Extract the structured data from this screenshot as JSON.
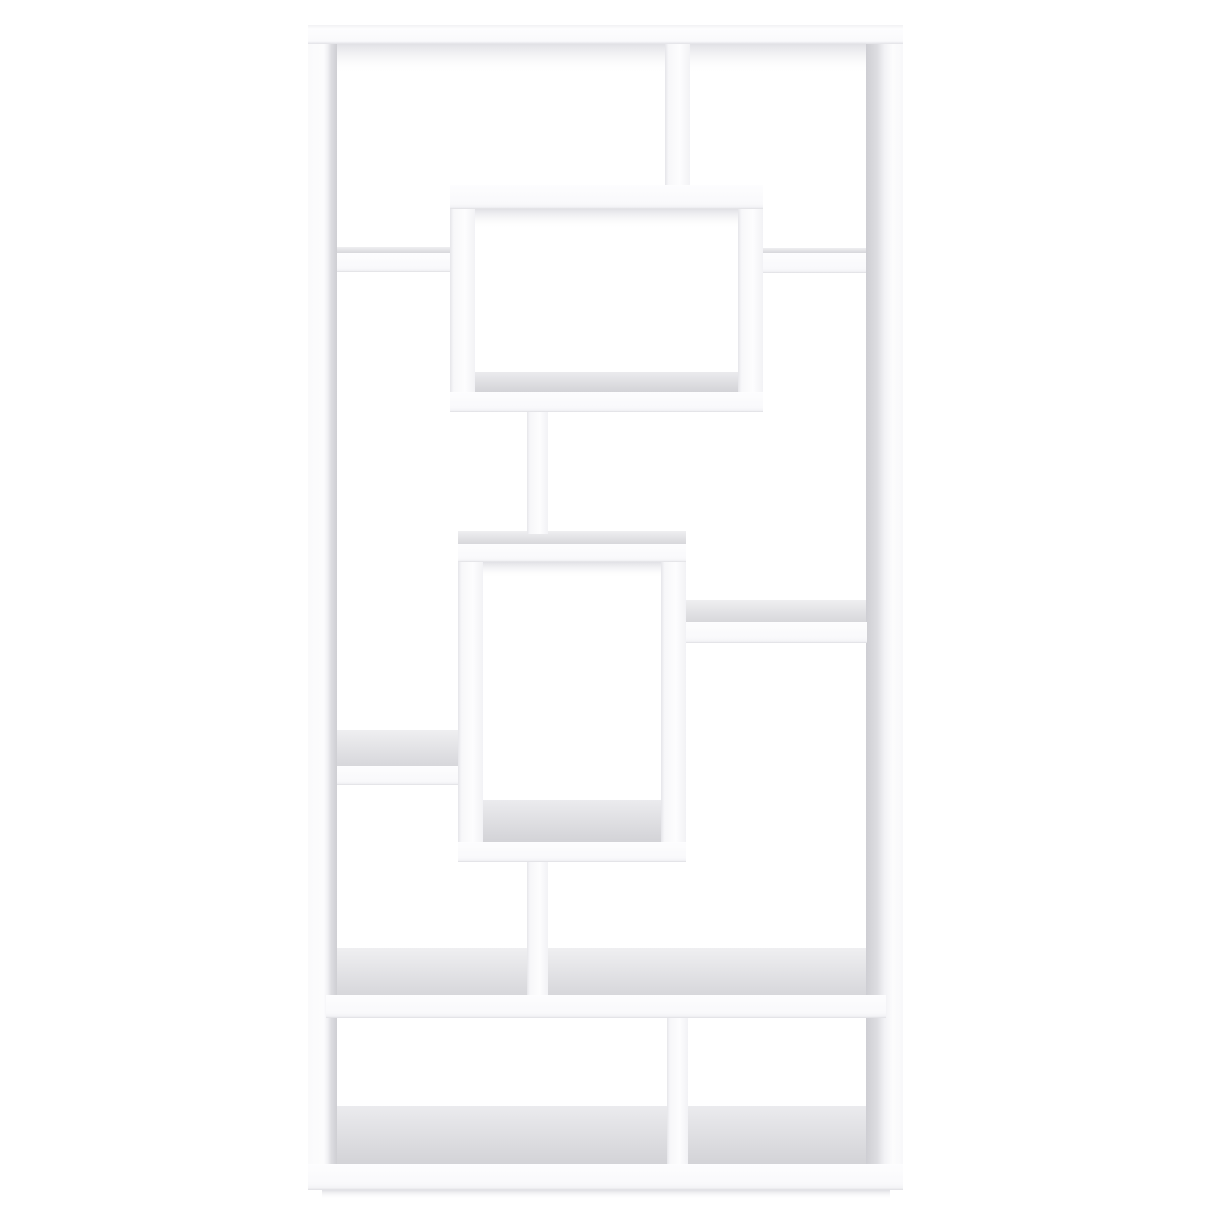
{
  "scene": {
    "width": 1214,
    "height": 1214,
    "background": "#ffffff",
    "alt": "Product photo of a tall white geometric bookcase with ten asymmetric open compartments, interlocking rectangular boxes and shelves, on a plain white background"
  },
  "palette": {
    "board_white": "#fcfcfd",
    "edge_gray": "#dedee2",
    "surface_gray": "#dcdcdf",
    "inner_face_gray": "#ceced3",
    "shadow_gray": "#c3c3cc"
  },
  "gradients": {
    "topBoardFace": {
      "dir": "v",
      "stops": [
        [
          0,
          "#f2f2f4"
        ],
        [
          0.2,
          "#fdfdfe"
        ],
        [
          0.85,
          "#fafafc"
        ],
        [
          1,
          "#e2e2e6"
        ]
      ]
    },
    "boardFace": {
      "dir": "v",
      "stops": [
        [
          0,
          "#fdfdfe"
        ],
        [
          0.78,
          "#f9f9fb"
        ],
        [
          0.92,
          "#f3f3f6"
        ],
        [
          1,
          "#dedee2"
        ]
      ]
    },
    "vertFace": {
      "dir": "h",
      "stops": [
        [
          0,
          "#e6e6ea"
        ],
        [
          0.14,
          "#f7f7f9"
        ],
        [
          0.6,
          "#fdfdfe"
        ],
        [
          1,
          "#f2f2f5"
        ]
      ]
    },
    "leftPost": {
      "dir": "h",
      "stops": [
        [
          0,
          "#fafafb"
        ],
        [
          0.55,
          "#fcfcfd"
        ],
        [
          0.68,
          "#f0f0f3"
        ],
        [
          0.8,
          "#dddde1"
        ],
        [
          1,
          "#ceced3"
        ]
      ]
    },
    "rightPost": {
      "dir": "h",
      "stops": [
        [
          0,
          "#ceced3"
        ],
        [
          0.3,
          "#dddde1"
        ],
        [
          0.5,
          "#f2f2f5"
        ],
        [
          0.72,
          "#fcfcfd"
        ],
        [
          1,
          "#f8f8fa"
        ]
      ]
    },
    "topSurf": {
      "dir": "v",
      "stops": [
        [
          0,
          "#efeff1"
        ],
        [
          1,
          "#d7d7db"
        ]
      ]
    },
    "floorSurf": {
      "dir": "v",
      "stops": [
        [
          0,
          "#ebebee"
        ],
        [
          1,
          "#d3d3d7"
        ]
      ]
    },
    "ceilShadow": {
      "dir": "v",
      "stops": [
        [
          0,
          "rgba(195,195,204,0.5)"
        ],
        [
          1,
          "rgba(255,255,255,0)"
        ]
      ]
    },
    "groundShadow": {
      "dir": "v",
      "stops": [
        [
          0,
          "rgba(185,185,195,0.45)"
        ],
        [
          1,
          "rgba(255,255,255,0)"
        ]
      ]
    }
  },
  "surfaces": [
    {
      "name": "top-opening-ceiling-shadow",
      "x": 337,
      "y": 44,
      "w": 529,
      "h": 30,
      "fill": "ceilShadow"
    },
    {
      "name": "upper-box-ceiling-shadow",
      "x": 475,
      "y": 209,
      "w": 263,
      "h": 20,
      "fill": "ceilShadow"
    },
    {
      "name": "upper-box-floor-surface",
      "x": 475,
      "y": 372,
      "w": 263,
      "h": 20,
      "fill": "floorSurf"
    },
    {
      "name": "left-shelf1-top-surface",
      "x": 337,
      "y": 247,
      "w": 113,
      "h": 6,
      "fill": "topSurf"
    },
    {
      "name": "right-shelf1-top-surface",
      "x": 763,
      "y": 248,
      "w": 103,
      "h": 5,
      "fill": "topSurf"
    },
    {
      "name": "lower-box-top-surface",
      "x": 458,
      "y": 531,
      "w": 228,
      "h": 13,
      "fill": "topSurf"
    },
    {
      "name": "lower-box-ceiling-shadow",
      "x": 483,
      "y": 562,
      "w": 178,
      "h": 16,
      "fill": "ceilShadow"
    },
    {
      "name": "lower-box-floor-surface",
      "x": 483,
      "y": 800,
      "w": 178,
      "h": 42,
      "fill": "floorSurf"
    },
    {
      "name": "mid-right-shelf-top-surface",
      "x": 686,
      "y": 600,
      "w": 181,
      "h": 22,
      "fill": "topSurf"
    },
    {
      "name": "left-shelf2-top-surface",
      "x": 337,
      "y": 730,
      "w": 121,
      "h": 36,
      "fill": "topSurf"
    },
    {
      "name": "big-shelf-top-surface",
      "x": 337,
      "y": 948,
      "w": 529,
      "h": 47,
      "fill": "topSurf"
    },
    {
      "name": "bottom-floor-surface",
      "x": 337,
      "y": 1106,
      "w": 529,
      "h": 58,
      "fill": "floorSurf"
    },
    {
      "name": "plinth-ground-shadow",
      "x": 322,
      "y": 1190,
      "w": 568,
      "h": 9,
      "fill": "groundShadow"
    }
  ],
  "boards": [
    {
      "name": "left-post",
      "x": 308,
      "y": 25,
      "w": 29,
      "h": 1165,
      "fill": "leftPost"
    },
    {
      "name": "right-post",
      "x": 866,
      "y": 25,
      "w": 37,
      "h": 1165,
      "fill": "rightPost"
    },
    {
      "name": "top-board",
      "x": 308,
      "y": 25,
      "w": 595,
      "h": 19,
      "fill": "topBoardFace"
    },
    {
      "name": "top-divider",
      "x": 665,
      "y": 44,
      "w": 25,
      "h": 146,
      "fill": "vertFace"
    },
    {
      "name": "upper-box-top-board",
      "x": 450,
      "y": 185,
      "w": 313,
      "h": 24,
      "fill": "boardFace"
    },
    {
      "name": "upper-box-left-wall",
      "x": 450,
      "y": 209,
      "w": 25,
      "h": 183,
      "fill": "vertFace"
    },
    {
      "name": "upper-box-right-wall",
      "x": 738,
      "y": 209,
      "w": 25,
      "h": 183,
      "fill": "vertFace"
    },
    {
      "name": "left-shelf-1",
      "x": 337,
      "y": 253,
      "w": 113,
      "h": 19,
      "fill": "boardFace"
    },
    {
      "name": "right-shelf-1",
      "x": 763,
      "y": 253,
      "w": 103,
      "h": 20,
      "fill": "boardFace"
    },
    {
      "name": "upper-box-bottom-board",
      "x": 450,
      "y": 392,
      "w": 313,
      "h": 20,
      "fill": "boardFace"
    },
    {
      "name": "center-stem-upper",
      "x": 527,
      "y": 412,
      "w": 21,
      "h": 122,
      "fill": "vertFace"
    },
    {
      "name": "lower-box-top-board",
      "x": 458,
      "y": 544,
      "w": 228,
      "h": 18,
      "fill": "boardFace"
    },
    {
      "name": "lower-box-left-wall",
      "x": 458,
      "y": 562,
      "w": 25,
      "h": 280,
      "fill": "vertFace"
    },
    {
      "name": "lower-box-right-wall",
      "x": 661,
      "y": 562,
      "w": 25,
      "h": 280,
      "fill": "vertFace"
    },
    {
      "name": "mid-right-shelf",
      "x": 686,
      "y": 622,
      "w": 181,
      "h": 21,
      "fill": "boardFace"
    },
    {
      "name": "left-shelf-2",
      "x": 337,
      "y": 766,
      "w": 121,
      "h": 19,
      "fill": "boardFace"
    },
    {
      "name": "lower-box-bottom-board",
      "x": 458,
      "y": 842,
      "w": 228,
      "h": 20,
      "fill": "boardFace"
    },
    {
      "name": "center-stem-lower",
      "x": 527,
      "y": 862,
      "w": 21,
      "h": 138,
      "fill": "vertFace"
    },
    {
      "name": "full-width-shelf",
      "x": 326,
      "y": 995,
      "w": 560,
      "h": 23,
      "fill": "boardFace"
    },
    {
      "name": "bottom-divider",
      "x": 667,
      "y": 1018,
      "w": 21,
      "h": 149,
      "fill": "vertFace"
    },
    {
      "name": "bottom-plinth",
      "x": 308,
      "y": 1164,
      "w": 595,
      "h": 26,
      "fill": "boardFace"
    }
  ]
}
